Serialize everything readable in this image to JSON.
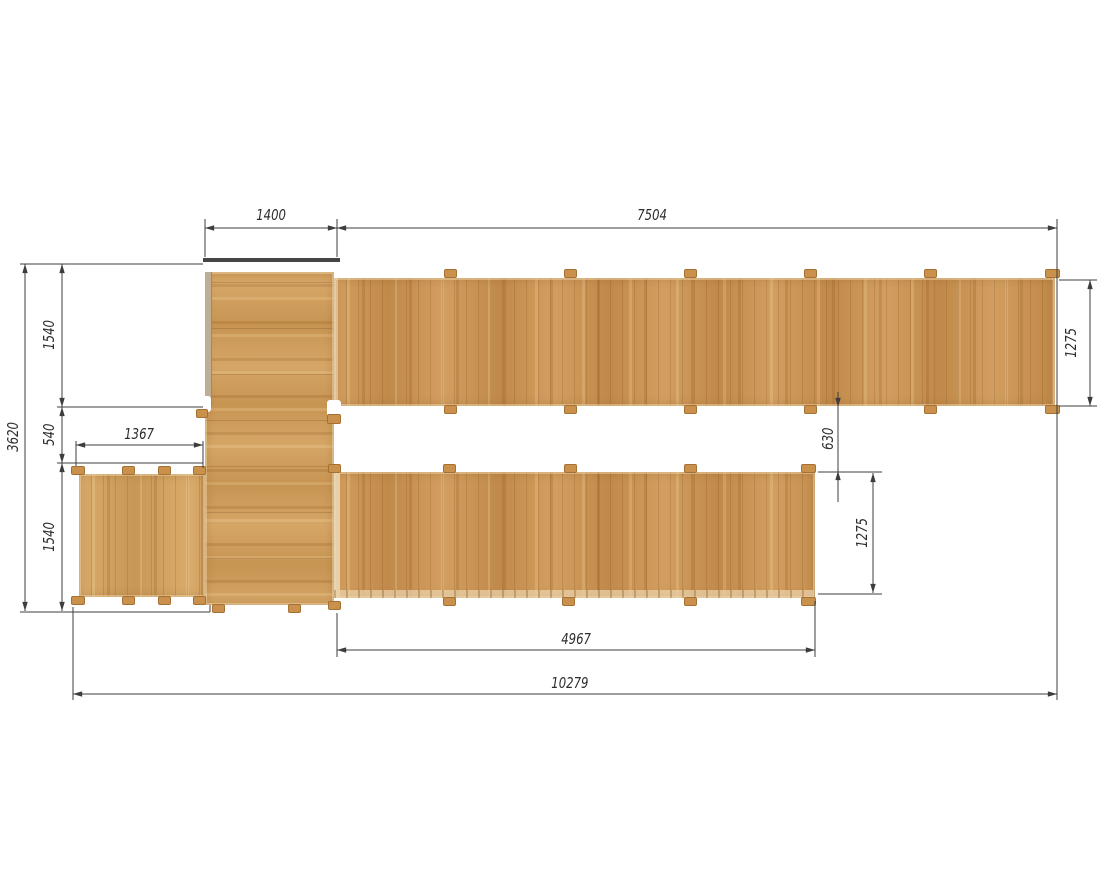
{
  "drawing_type": "plan-view technical drawing of wooden walkway structure",
  "units_implied": "mm",
  "dimensions": {
    "top": {
      "platform_width": "1400",
      "upper_walkway_length": "7504"
    },
    "left": {
      "overall_depth": "3620",
      "upper_depth": "1540",
      "middle_depth": "540",
      "side_deck_width": "1367",
      "lower_depth": "1540"
    },
    "right": {
      "upper_walkway_depth": "1275"
    },
    "middle": {
      "walkway_gap": "630",
      "lower_walkway_depth": "1275"
    },
    "bottom": {
      "lower_walkway_length": "4967",
      "overall_length": "10279"
    }
  },
  "colors": {
    "wood_base": "#cc9350",
    "wood_light": "#e0ac63",
    "wood_dark": "#a8762f",
    "side_deck_wood": "#d4a25e",
    "platform_wood": "#d09c58",
    "edge_board": "#454545",
    "dimension_line": "#3d3d3d",
    "dimension_text": "#2d2d2d",
    "background": "#ffffff"
  }
}
